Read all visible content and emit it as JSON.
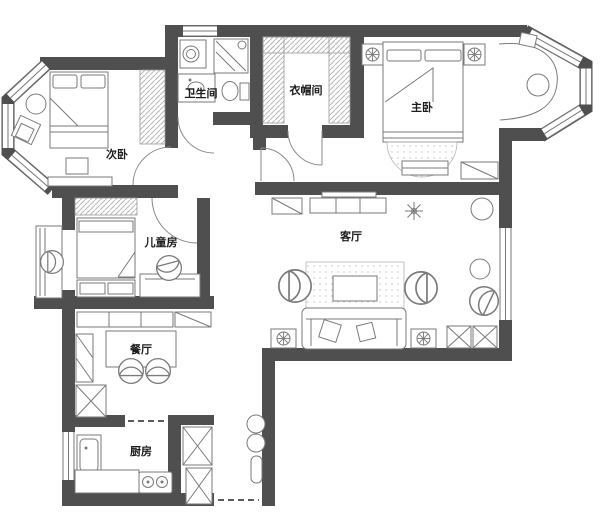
{
  "colors": {
    "wall": "#4f4f4f",
    "line": "#7a7a7a",
    "hatch": "#b8b8b8",
    "label": "#1c1c1c",
    "bg": "#ffffff"
  },
  "rooms": [
    {
      "id": "secondary-bedroom",
      "label": "次卧",
      "x": 117,
      "y": 158
    },
    {
      "id": "bathroom",
      "label": "卫生间",
      "x": 201,
      "y": 97
    },
    {
      "id": "cloakroom",
      "label": "衣帽间",
      "x": 306,
      "y": 94
    },
    {
      "id": "master-bedroom",
      "label": "主卧",
      "x": 422,
      "y": 111
    },
    {
      "id": "kids-room",
      "label": "儿童房",
      "x": 161,
      "y": 246
    },
    {
      "id": "living-room",
      "label": "客厅",
      "x": 351,
      "y": 240
    },
    {
      "id": "dining-room",
      "label": "餐厅",
      "x": 141,
      "y": 353
    },
    {
      "id": "kitchen",
      "label": "厨房",
      "x": 141,
      "y": 455
    }
  ],
  "icons": {
    "plant-icon": "six-spoke star flower",
    "table-lamp-icon": "circle with cross spokes",
    "washer-icon": "front-load drum circle",
    "stove-icon": "two round burners",
    "sink-icon": "basin with faucet dot",
    "toilet-icon": "bowl with tank"
  }
}
